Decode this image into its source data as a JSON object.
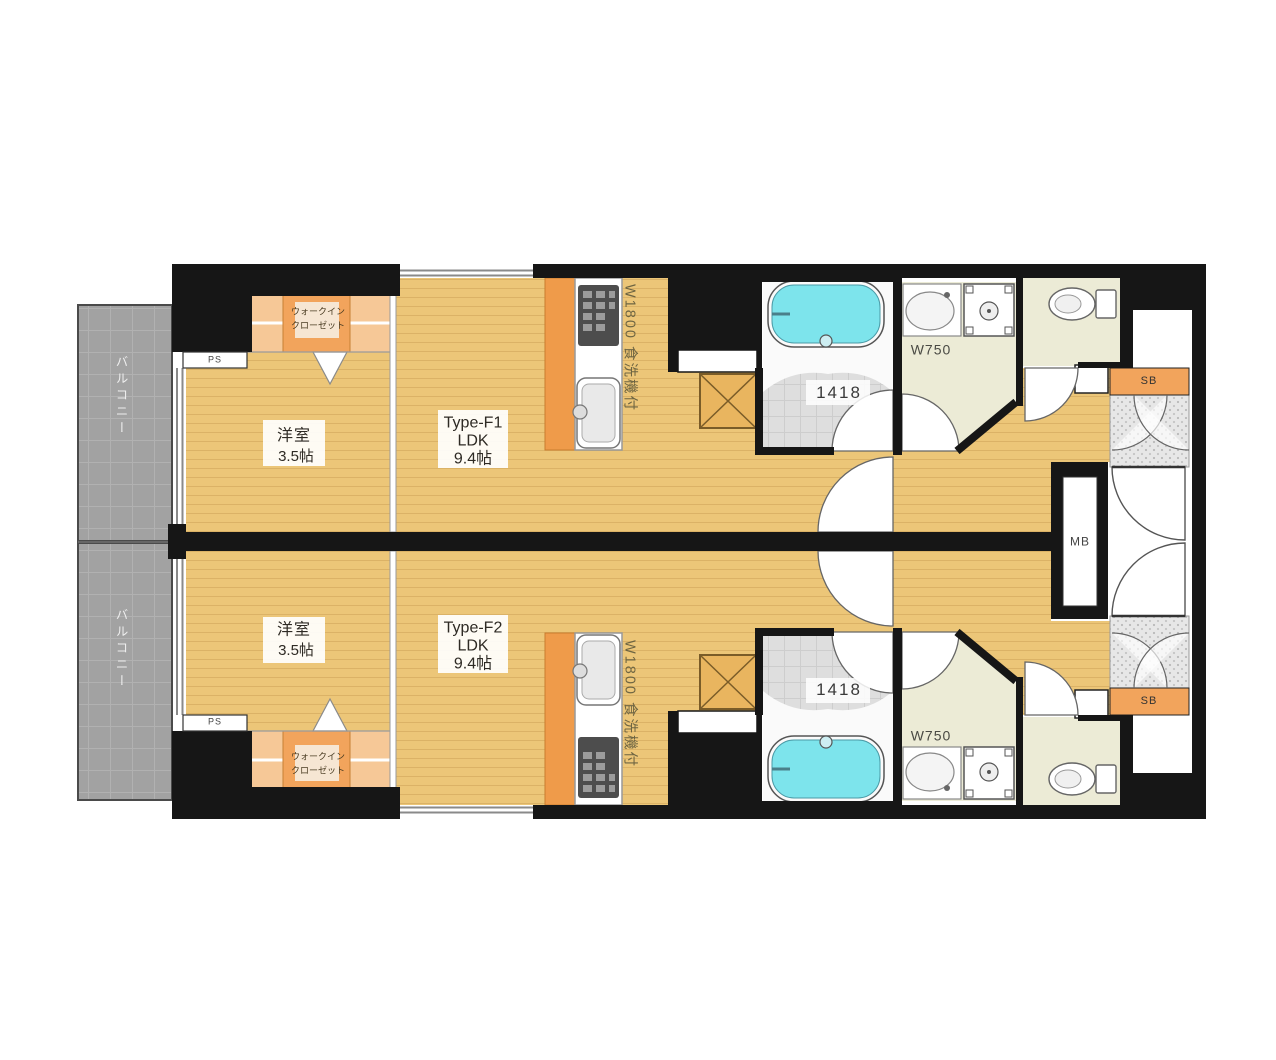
{
  "plan": {
    "mb_label": "MB",
    "units": [
      {
        "type_label": "Type-F1",
        "ldk_label": "LDK",
        "ldk_size": "9.4帖",
        "bedroom_label": "洋室",
        "bedroom_size": "3.5帖",
        "kitchen_label": "W1800 食洗機付",
        "bath_size": "1418",
        "vanity_label": "W750",
        "shoebox_label": "SB",
        "ps_label": "PS",
        "wic_line1": "ウォークイン",
        "wic_line2": "クローゼット",
        "balcony_label": "バルコニー"
      },
      {
        "type_label": "Type-F2",
        "ldk_label": "LDK",
        "ldk_size": "9.4帖",
        "bedroom_label": "洋室",
        "bedroom_size": "3.5帖",
        "kitchen_label": "W1800 食洗機付",
        "bath_size": "1418",
        "vanity_label": "W750",
        "shoebox_label": "SB",
        "ps_label": "PS",
        "wic_line1": "ウォークイン",
        "wic_line2": "クローゼット",
        "balcony_label": "バルコニー"
      }
    ],
    "colors": {
      "wall": "#161616",
      "wood_floor": "#ecc678",
      "closet_orange": "#f2a45c",
      "kitchen_orange": "#ef9b4a",
      "bathtub_cyan": "#7de4ec",
      "balcony_gray": "#a2a2a2",
      "service_floor": "#ecebd6"
    }
  }
}
